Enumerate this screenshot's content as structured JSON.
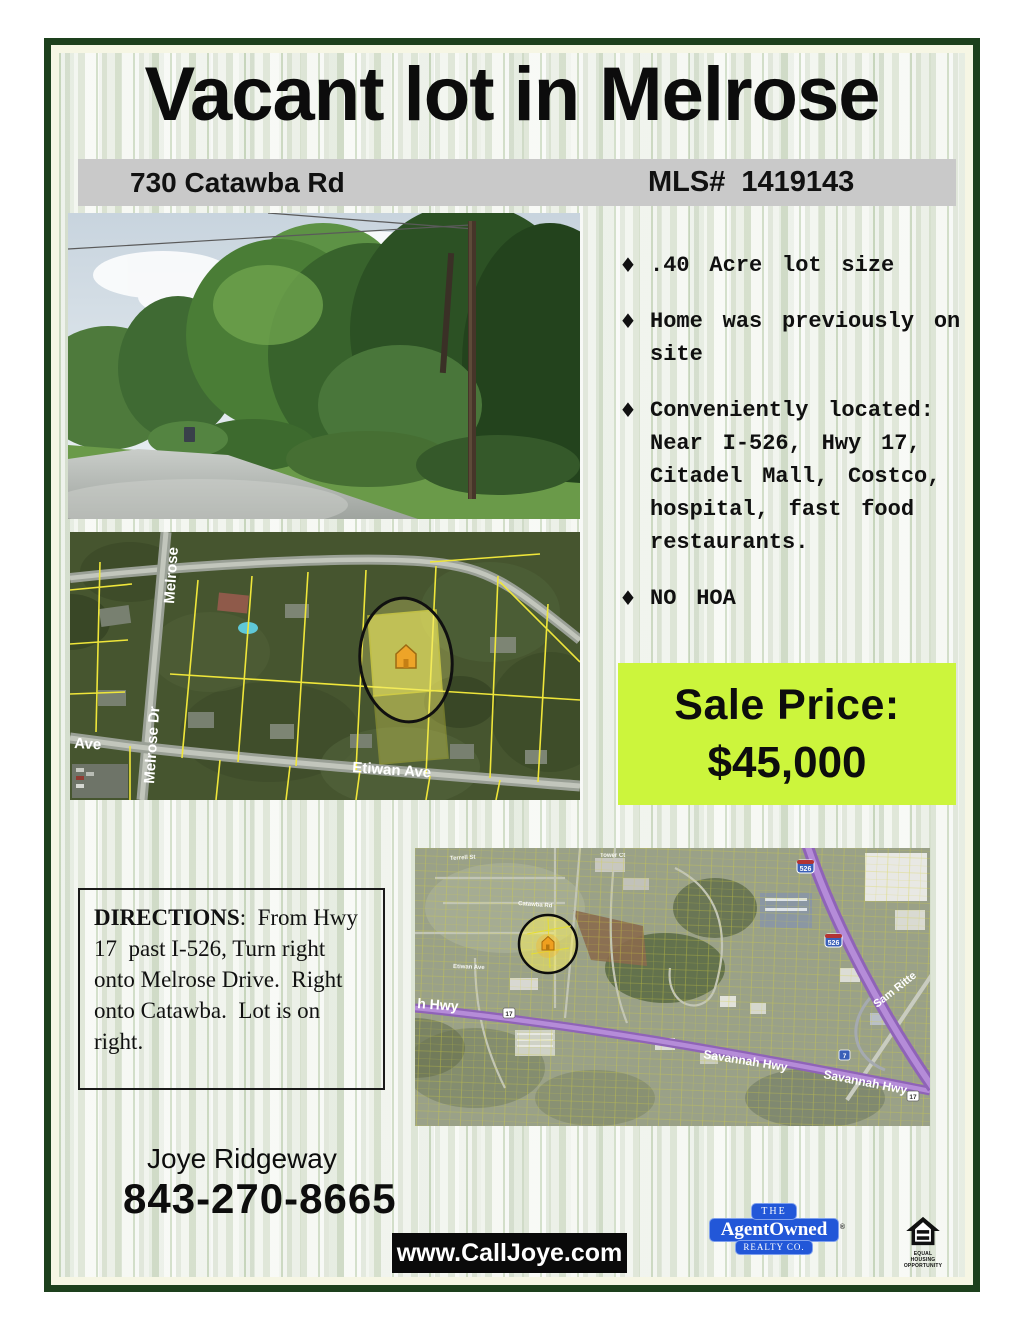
{
  "title": "Vacant lot in Melrose",
  "address_bar": {
    "address": "730 Catawba Rd",
    "mls": "MLS# 1419143"
  },
  "bullet_glyph": "♦",
  "features": [
    ".40 Acre lot size",
    "Home was previously on site",
    "Conveniently located: Near I-526, Hwy 17, Citadel Mall, Costco, hospital, fast food restaurants.",
    "NO HOA"
  ],
  "sale_price": {
    "label": "Sale Price:",
    "amount": "$45,000",
    "box_color": "#ccf53c"
  },
  "directions": {
    "heading": "DIRECTIONS",
    "body": ":  From Hwy 17  past I-526, Turn right onto Melrose Drive.  Right onto Catawba.  Lot is on right."
  },
  "agent": {
    "name": "Joye Ridgeway",
    "phone": "843-270-8665",
    "website": "www.CallJoye.com"
  },
  "brokerage": {
    "line1": "THE",
    "line2": "AgentOwned",
    "line3": "REALTY CO.",
    "reg_mark": "®",
    "brand_color": "#2257d8"
  },
  "equal_housing": {
    "line1": "EQUAL HOUSING",
    "line2": "OPPORTUNITY"
  },
  "colors": {
    "border_green": "#1d401d",
    "bar_gray": "#c9c9c9",
    "price_green": "#ccf53c"
  },
  "parcel_map": {
    "labels": {
      "street_top": "Melrose",
      "street_left": "Melrose Dr",
      "ave": "Ave",
      "bottom": "Etiwan Ave"
    }
  },
  "area_map": {
    "labels": {
      "hwy_left": "h Hwy",
      "savannah1": "Savannah Hwy",
      "savannah2": "Savannah Hwy",
      "sam_rittenberg": "Sam Ritte",
      "interstate_1": "526",
      "interstate_2": "526",
      "route17_1": "17",
      "route17_2": "17",
      "route7": "7",
      "terrell": "Terrell St",
      "catawba": "Catawba Rd",
      "etiwan": "Etiwan Ave",
      "tower": "Tower Ct"
    }
  }
}
